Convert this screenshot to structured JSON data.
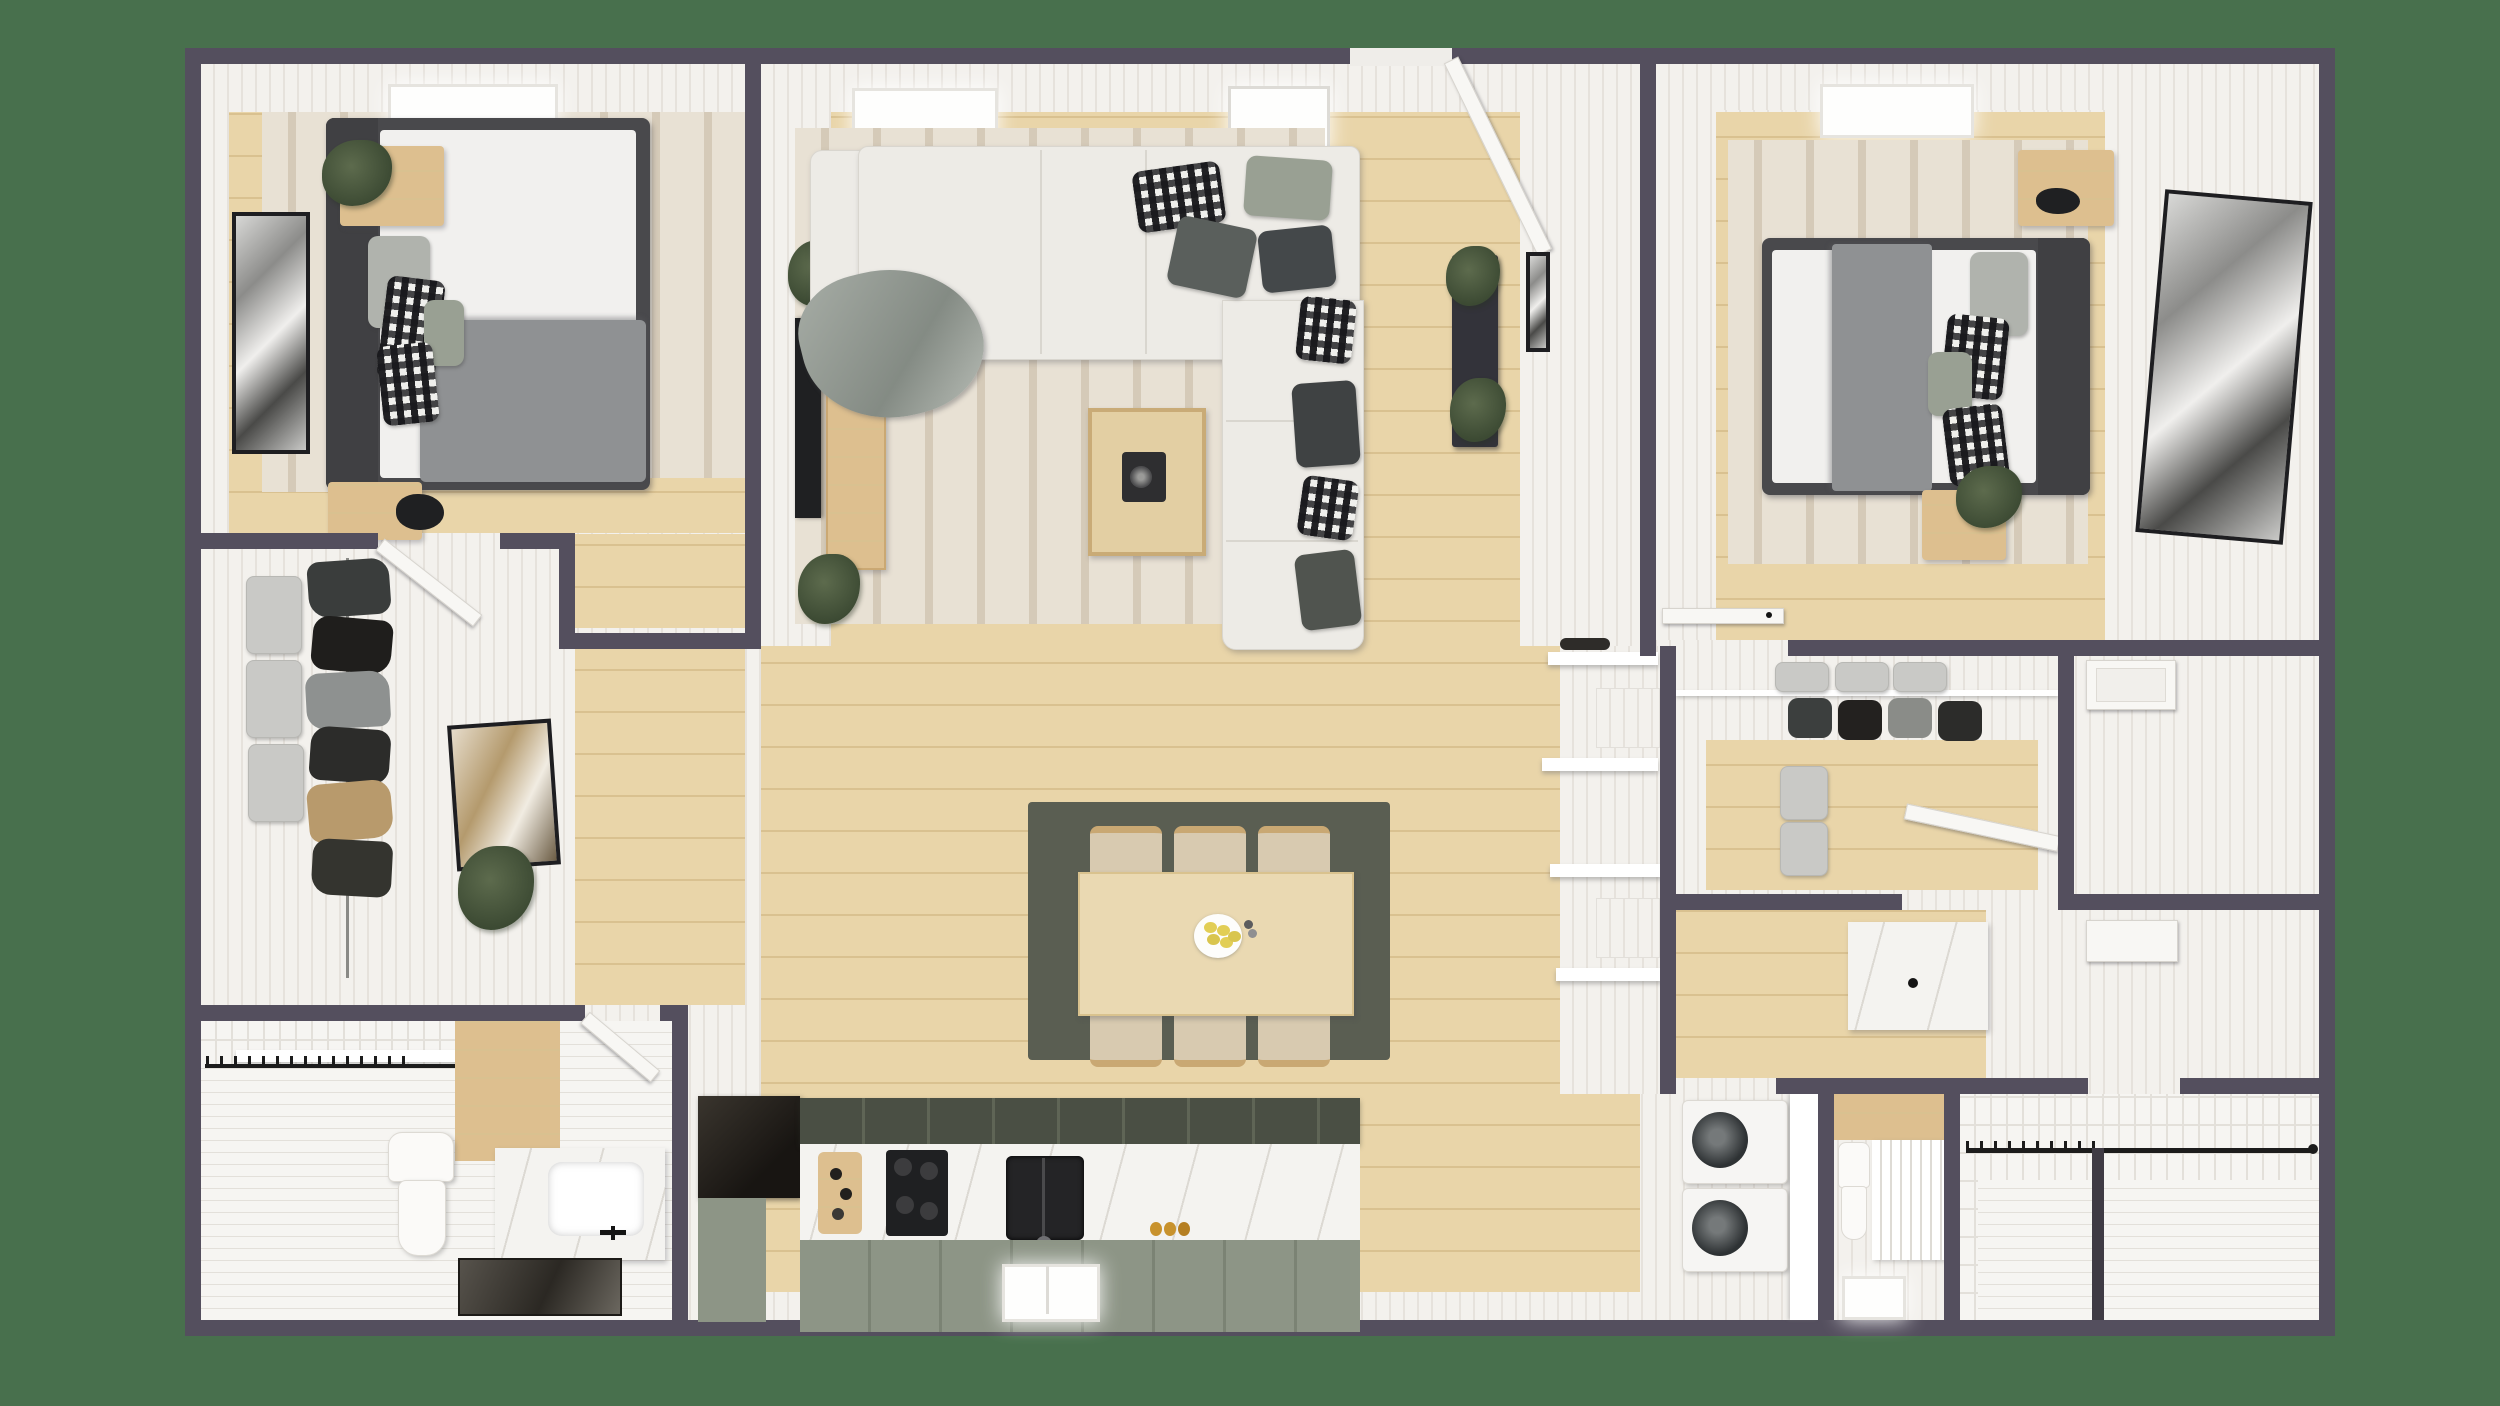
{
  "scene": {
    "description": "3D rendered top-down floor plan of a two-bedroom apartment with central living/dining/kitchen zone, bedrooms on both sides, walk-in closets, two bathrooms, laundry and shower room",
    "background_color": "#48704d"
  },
  "palette": {
    "bg": "#48704d",
    "wall": "#544f5e",
    "trim": "#f3f1ed",
    "trim_line": "#e6e2dc",
    "wood": "#e9d5a9",
    "wood_line": "#d9c190",
    "wood_dark": "#ddbf8f",
    "rug": "#e8e1d4",
    "rug_stripe": "#d5cab8",
    "dining_rug": "#5a5e52",
    "bed_frame": "#49494c",
    "mattress": "#f1f0ee",
    "blanket": "#8f9193",
    "pillow_gray": "#b0b3ad",
    "pillow_sage": "#99a093",
    "sofa": "#edebe6",
    "sofa_line": "#d9d6cf",
    "coffee_table": "#e3cfa3",
    "table_wood": "#ead9b2",
    "chair_cushion": "#d8cab0",
    "chair_wood": "#c9a873",
    "cab_dark": "#4a4f44",
    "cab_line": "#5f6556",
    "sage": "#8d9586",
    "sage_line": "#7b8374",
    "marble": "#f4f3f0",
    "appliance_black": "#1f2022",
    "tile": "#f6f5f2",
    "tile_line": "#e3e0da",
    "box": "#c9c9c6",
    "door": "#f8f7f4",
    "plant_dark": "#3c4a33",
    "plant_light": "#5d6b4d",
    "art_frame": "#1e1e21",
    "amber": "#c8922d",
    "black_metal": "#2b2b2f",
    "lemon": "#e2ce55"
  },
  "rooms": [
    {
      "name": "bedroom-left",
      "furniture": [
        "double-bed",
        "nightstand-top",
        "nightstand-bottom",
        "wall-art",
        "striped-rug",
        "ceiling-light",
        "plant"
      ]
    },
    {
      "name": "walk-in-closet-left",
      "furniture": [
        "storage-boxes",
        "hanging-clothes",
        "leaning-art",
        "plant"
      ]
    },
    {
      "name": "bathroom-left",
      "furniture": [
        "shower-curtain-rod",
        "toilet",
        "vanity-sink",
        "mirror",
        "tiled-shower-wall"
      ]
    },
    {
      "name": "living-room",
      "furniture": [
        "sectional-sofa",
        "coffee-table",
        "record-player",
        "tv",
        "media-console",
        "plants",
        "striped-rug",
        "black-console-table",
        "wall-shelves",
        "entry-door"
      ]
    },
    {
      "name": "dining-area",
      "furniture": [
        "dining-table",
        "six-chairs",
        "fruit-plate",
        "olive-rug"
      ]
    },
    {
      "name": "kitchen",
      "furniture": [
        "fridge",
        "upper-cabinets",
        "marble-counter",
        "cooktop",
        "double-sink",
        "cutting-board",
        "window",
        "sage-cabinets"
      ]
    },
    {
      "name": "bedroom-right",
      "furniture": [
        "double-bed",
        "nightstand-north",
        "nightstand-south",
        "wall-art",
        "striped-rug",
        "ceiling-light",
        "door"
      ]
    },
    {
      "name": "closet-right",
      "furniture": [
        "storage-boxes",
        "hanging-clothes",
        "shelf",
        "door"
      ]
    },
    {
      "name": "linen-closet",
      "furniture": [
        "door-panel"
      ]
    },
    {
      "name": "bathroom-right",
      "furniture": [
        "marble-vanity"
      ]
    },
    {
      "name": "laundry-room",
      "furniture": [
        "washer",
        "dryer",
        "counter"
      ]
    },
    {
      "name": "wc",
      "furniture": [
        "toilet",
        "louver-screen",
        "window"
      ]
    },
    {
      "name": "shower-room",
      "furniture": [
        "curtain-rod",
        "subway-tile",
        "glass-partition"
      ]
    }
  ]
}
